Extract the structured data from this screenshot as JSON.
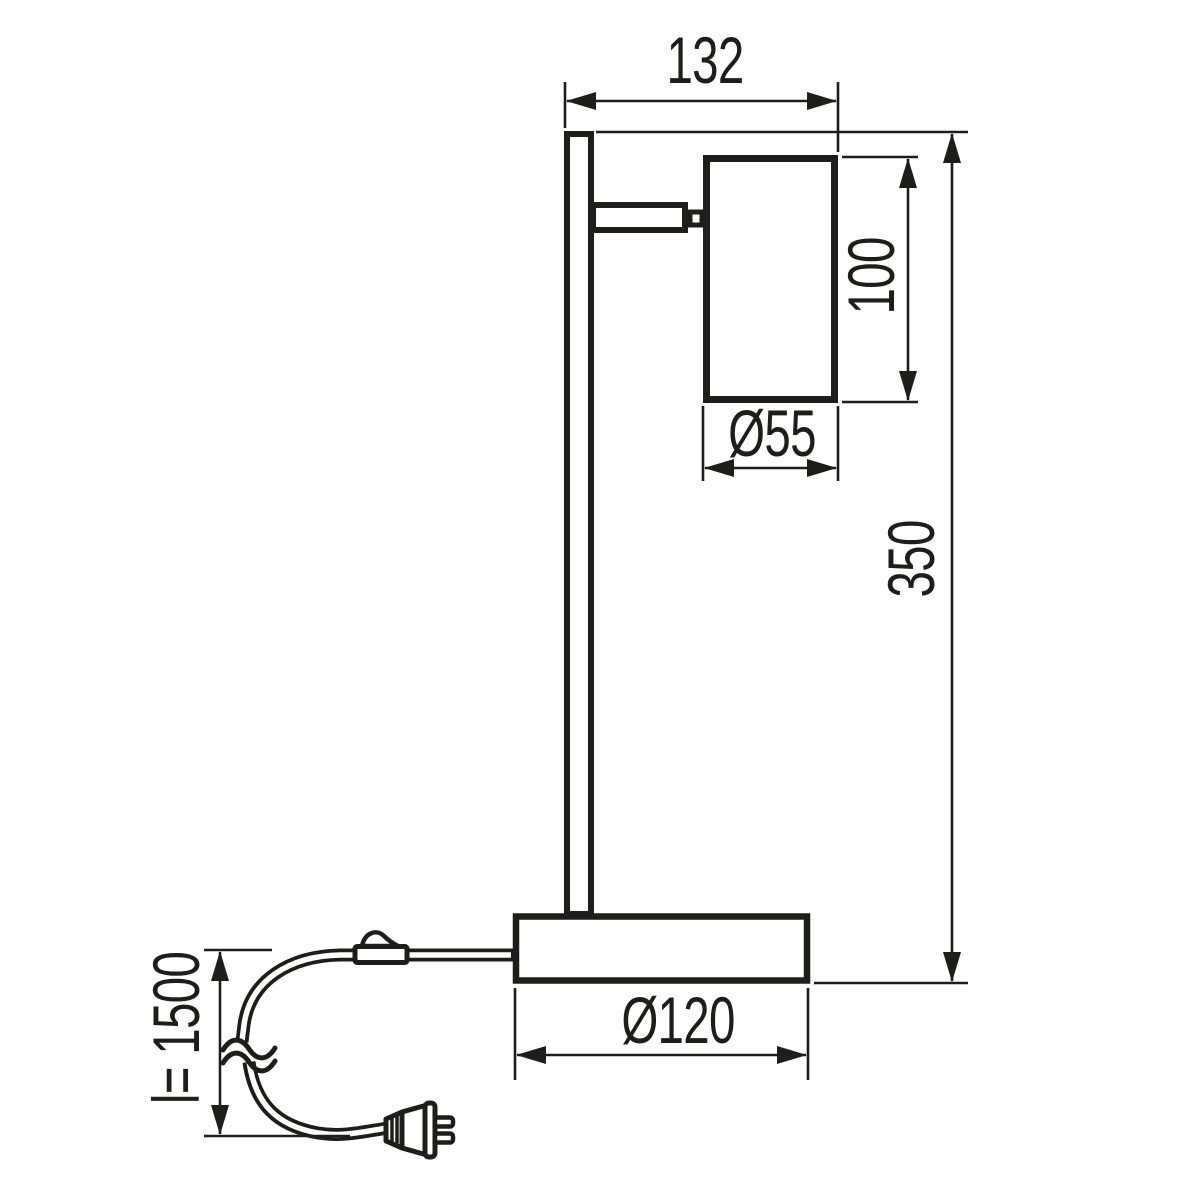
{
  "diagram": {
    "type": "technical-dimension-drawing",
    "subject": "table lamp side view with dimension annotations",
    "ink_color": "#1d1d1b",
    "background_color": "#ffffff",
    "dimensions": [
      {
        "id": "head_overhang_width",
        "label": "132",
        "orientation": "horizontal"
      },
      {
        "id": "shade_height",
        "label": "100",
        "orientation": "vertical"
      },
      {
        "id": "shade_diameter",
        "label": "Ø55",
        "orientation": "horizontal"
      },
      {
        "id": "total_height",
        "label": "350",
        "orientation": "vertical"
      },
      {
        "id": "base_diameter",
        "label": "Ø120",
        "orientation": "horizontal"
      },
      {
        "id": "cable_length",
        "label": "l= 1500",
        "orientation": "vertical"
      }
    ]
  }
}
